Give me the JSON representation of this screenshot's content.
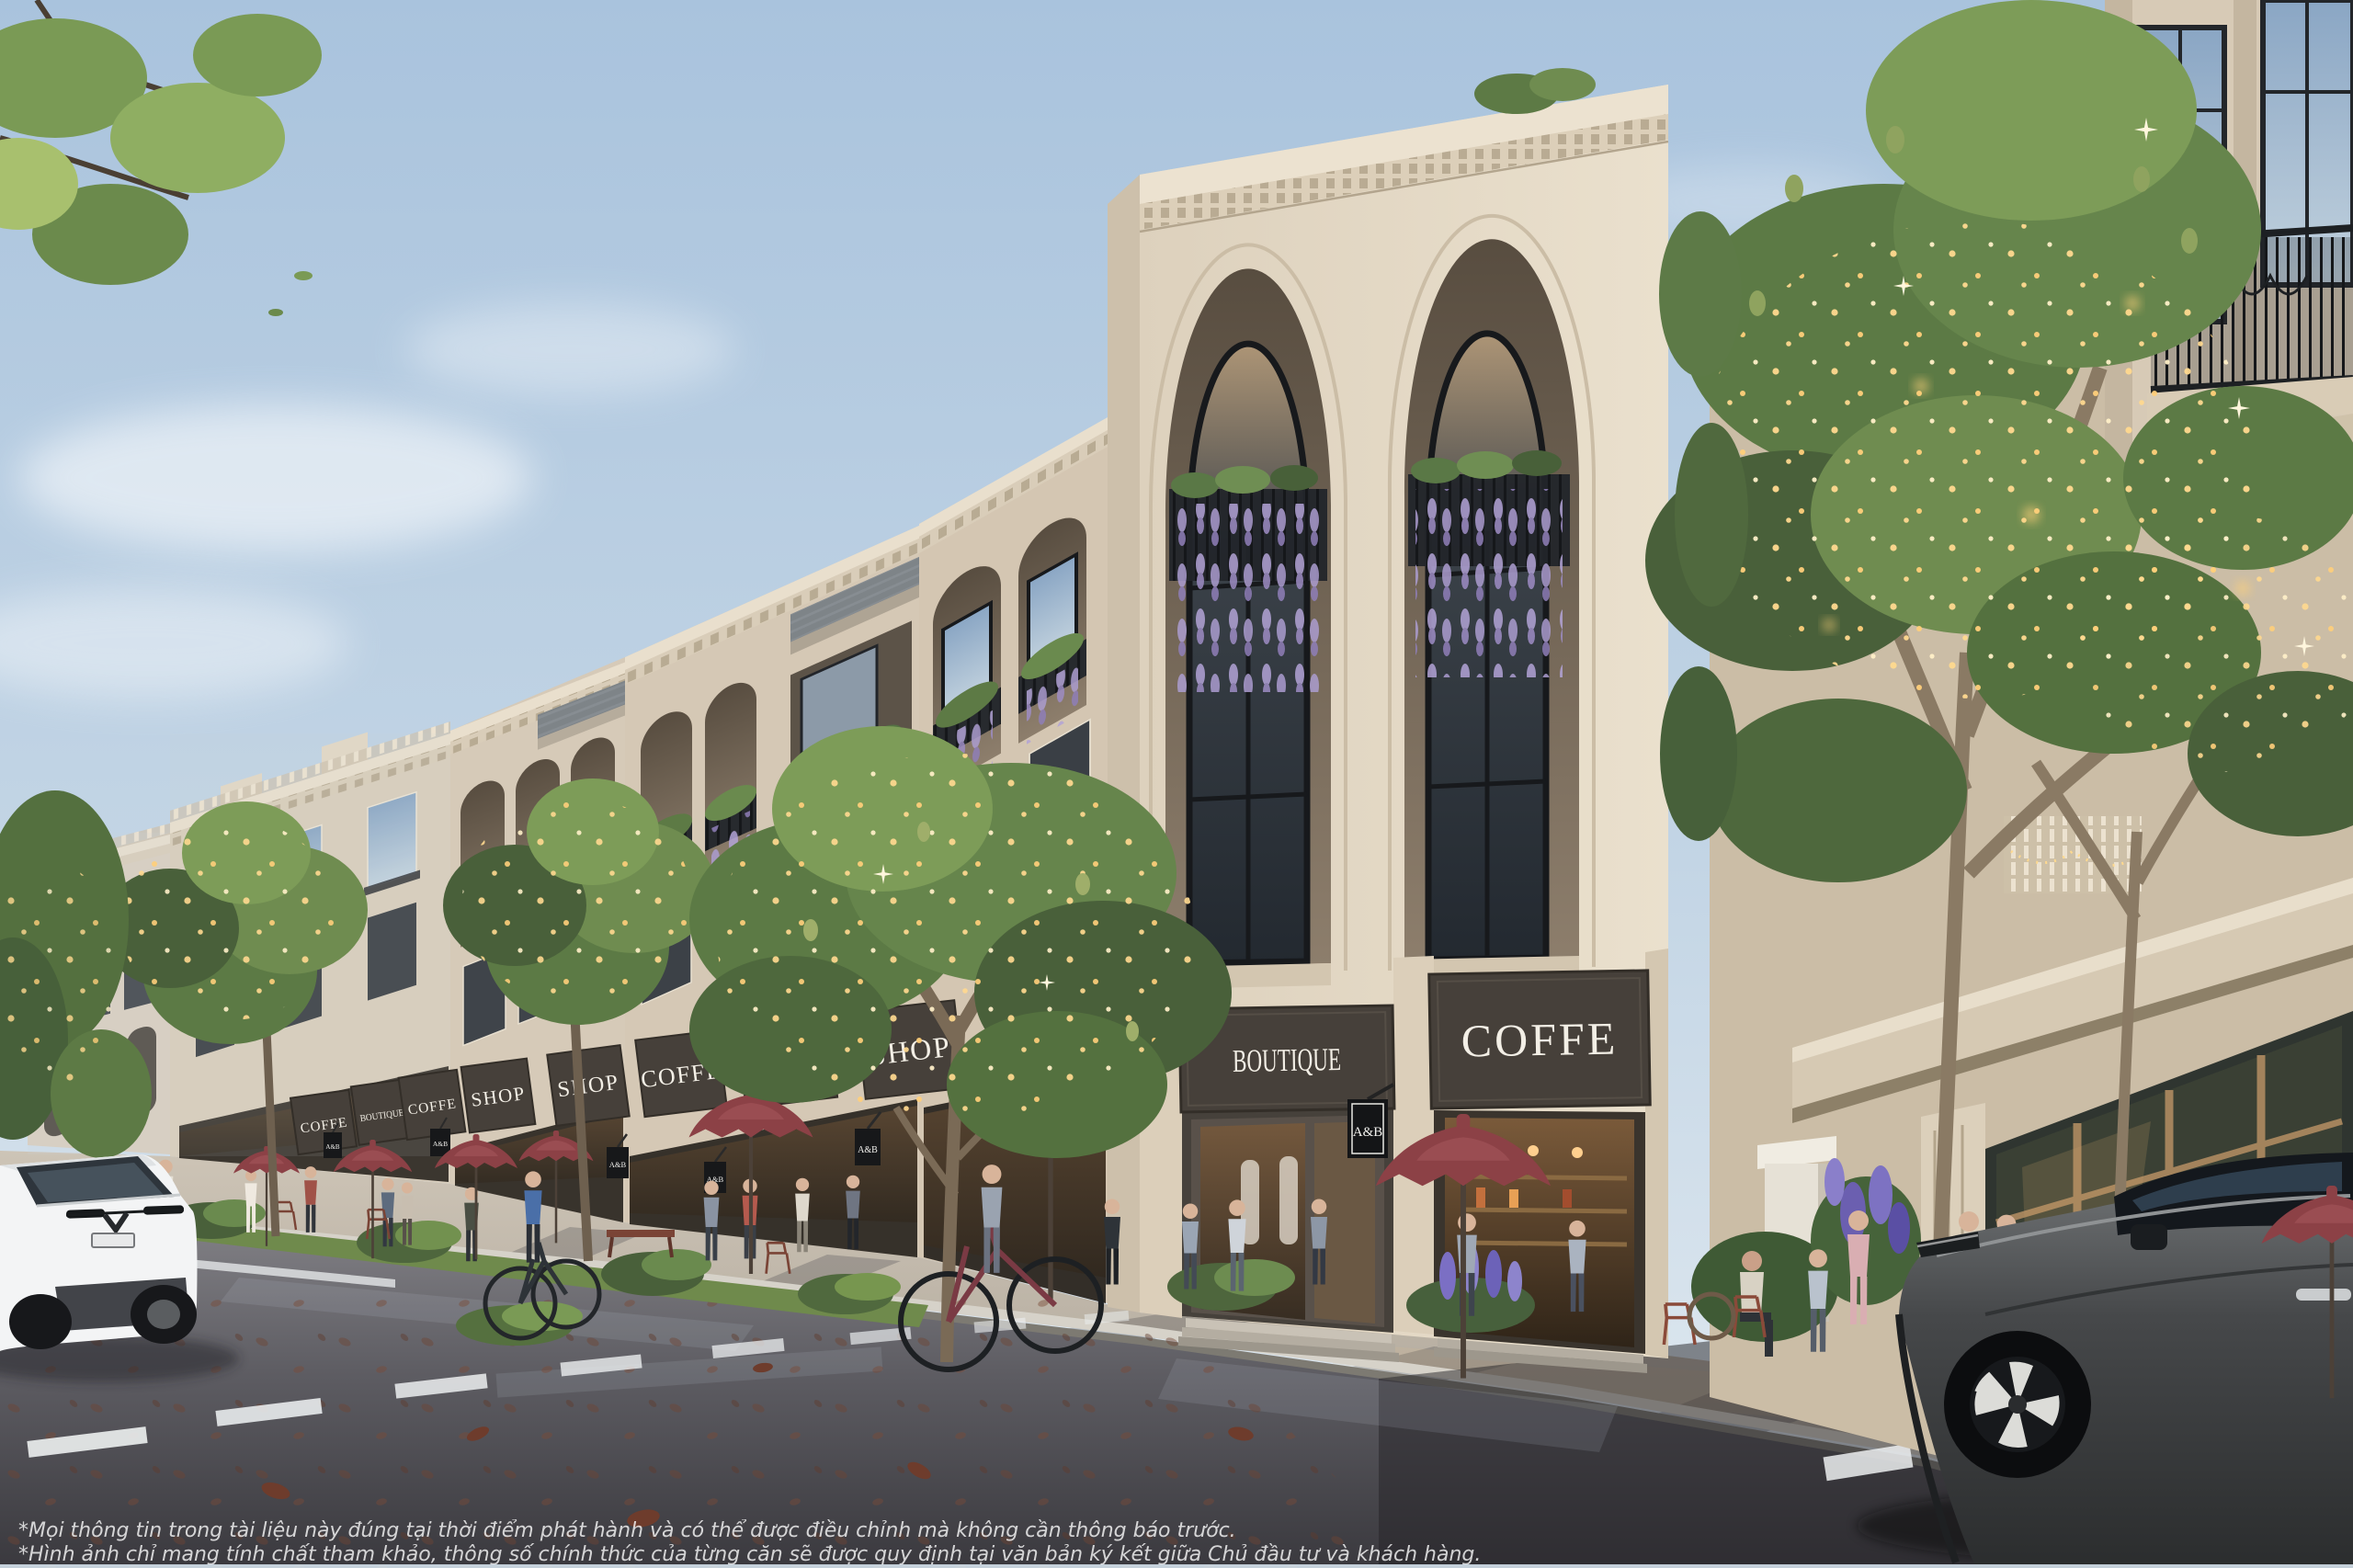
{
  "signs": {
    "storefronts": [
      {
        "label": "COFFE"
      },
      {
        "label": "BOUTIQUE"
      },
      {
        "label": "COFFE"
      },
      {
        "label": "SHOP"
      },
      {
        "label": "SHOP"
      },
      {
        "label": "COFFE"
      },
      {
        "label": "COFFE"
      },
      {
        "label": "SHOP"
      },
      {
        "label": "SHOP"
      },
      {
        "label": "BOUTIQUE"
      },
      {
        "label": "COFFE"
      }
    ],
    "hanging": {
      "label": "A&B"
    }
  },
  "disclaimer": {
    "line1": "*Mọi thông tin trong tài liệu này đúng tại thời điểm phát hành và có thể được điều chỉnh mà không cần thông báo trước.",
    "line2": "*Hình ảnh chỉ mang tính chất tham khảo, thông số chính thức của từng căn sẽ được quy định tại văn bản ký kết giữa Chủ đầu tư và khách hàng."
  },
  "colors": {
    "sky_top": "#a9c3dd",
    "sky_horizon": "#e3ebf1",
    "facade": "#ddd1bd",
    "facade_shadow": "#b5a893",
    "cornice": "#ece2d0",
    "signboard": "#46403a",
    "sign_text": "#f3efe6",
    "umbrella": "#8c4146",
    "road": "#6f6e73",
    "road_dark": "#2a292e",
    "sidewalk": "#c6bcae",
    "foliage": "#5d7a45",
    "string_lights": "#ffd98f",
    "wisteria": "#ab9ccf",
    "iron": "#24272b",
    "white_car": "#f3f4f5",
    "dark_suv": "#434546",
    "interior_glow": "#7a5a3a",
    "lavender": "#7b6fc4",
    "crosswalk_white": "#eceff0"
  }
}
